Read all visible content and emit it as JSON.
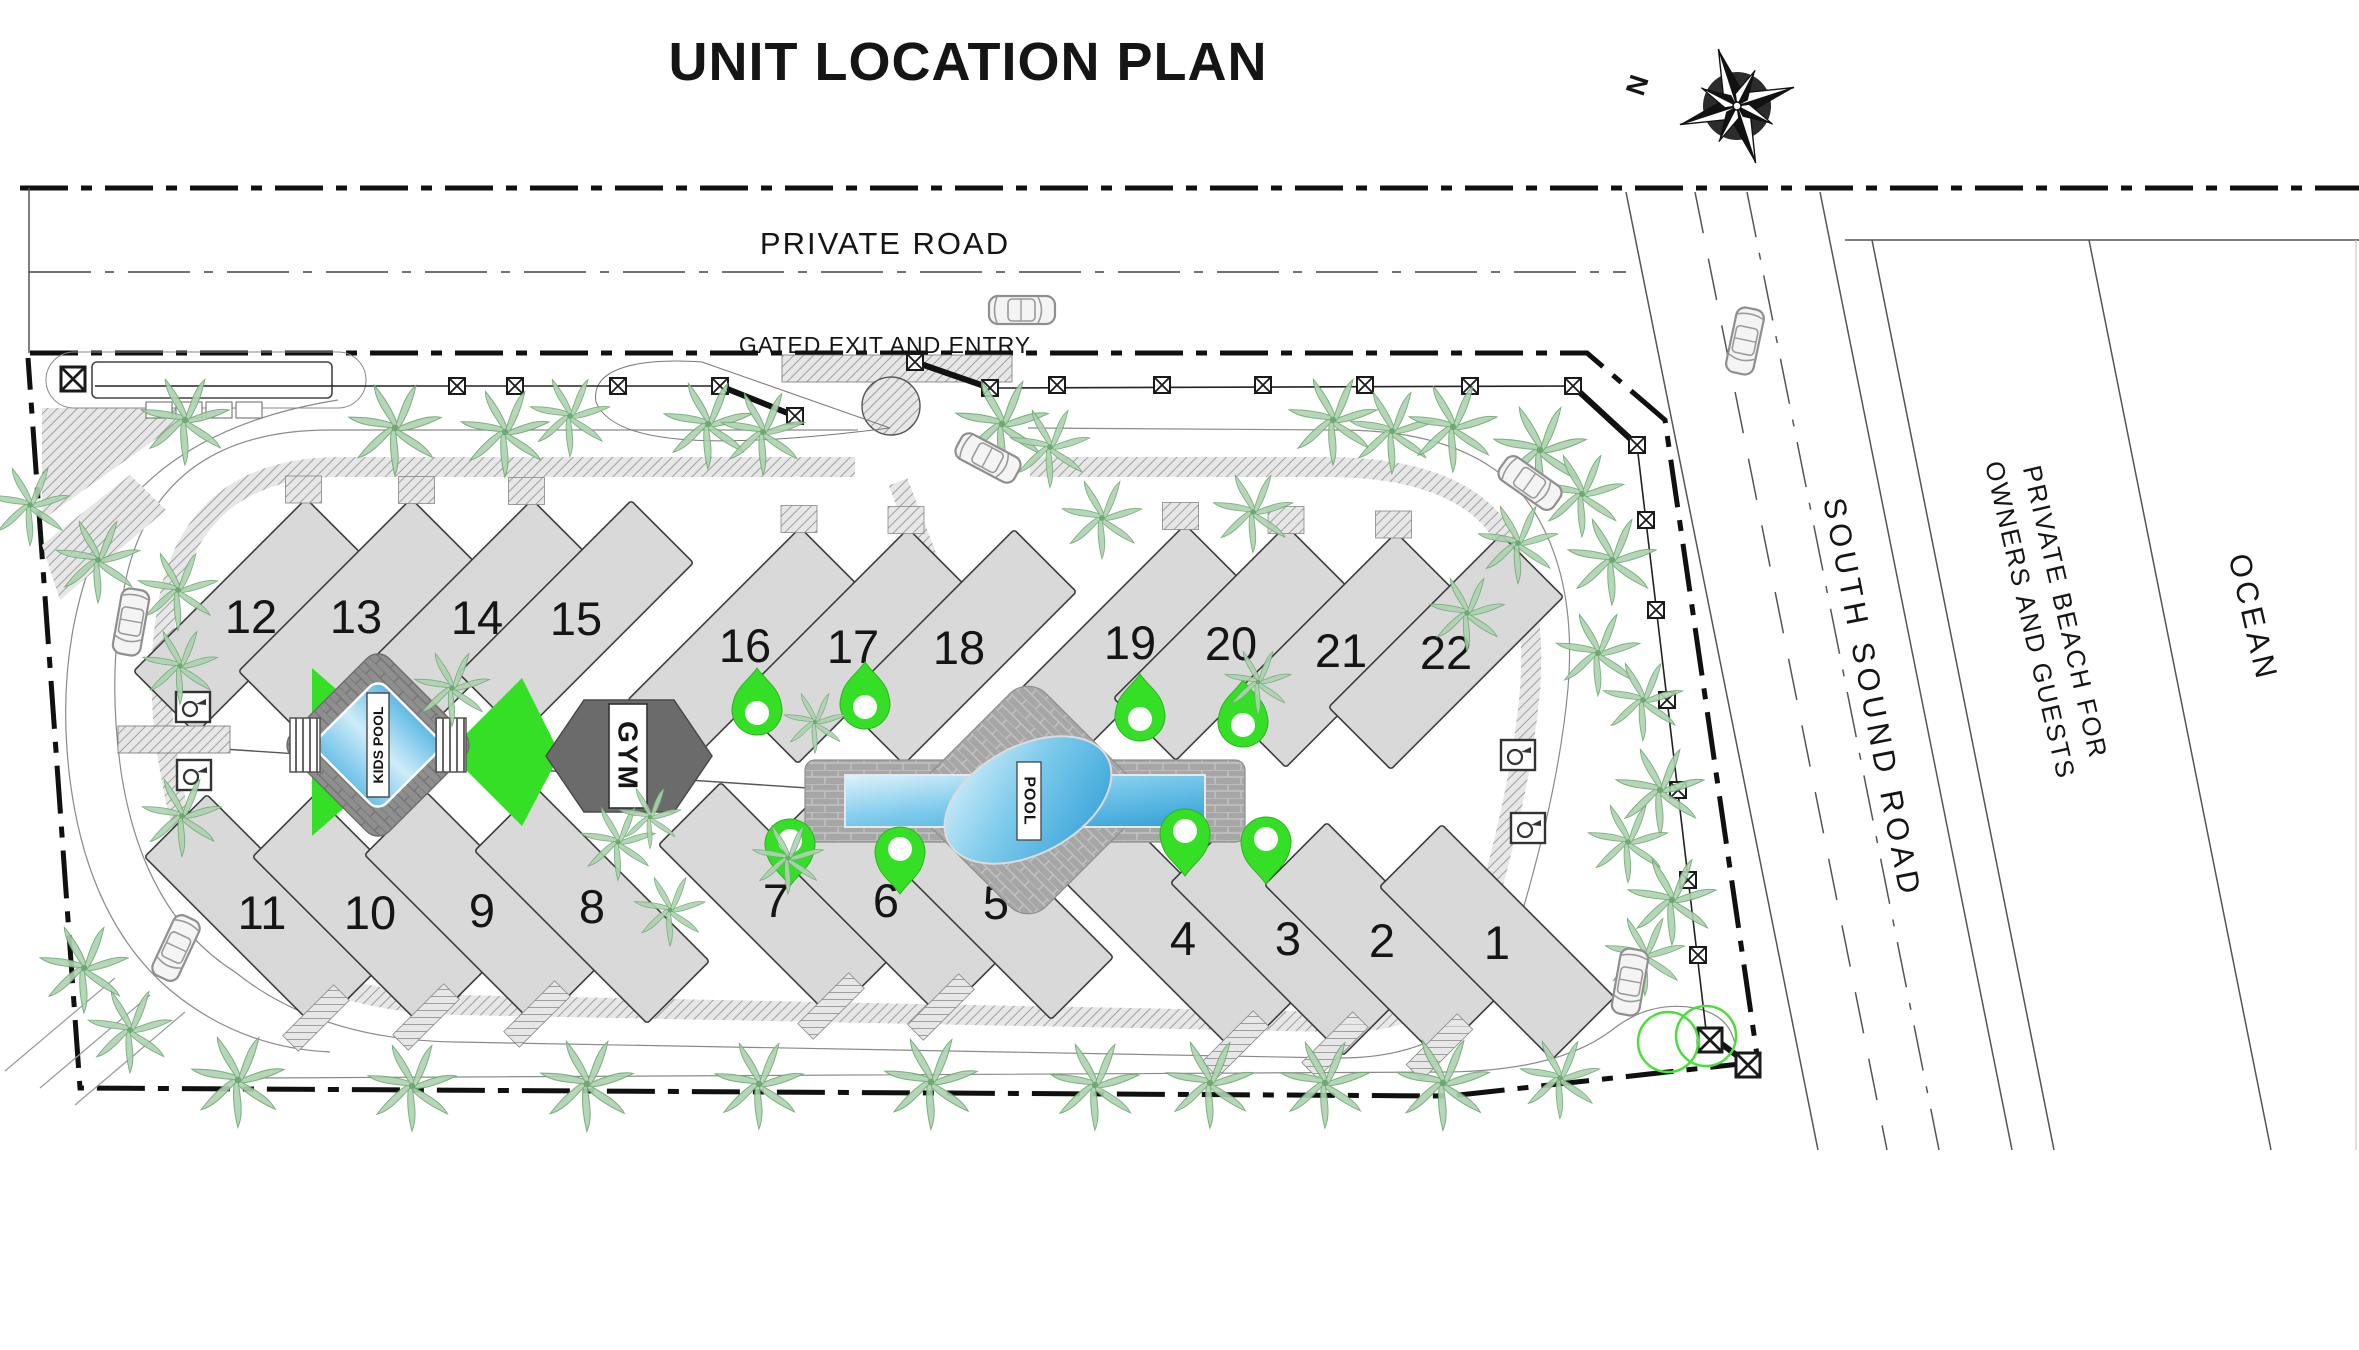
{
  "title": "UNIT LOCATION PLAN",
  "compass": {
    "north_label": "N"
  },
  "roads": {
    "private_road": "PRIVATE ROAD",
    "gate_label": "GATED EXIT AND ENTRY",
    "south_sound_road": "SOUTH SOUND ROAD"
  },
  "areas": {
    "beach_line1": "PRIVATE BEACH FOR",
    "beach_line2": "OWNERS AND GUESTS",
    "ocean": "OCEAN"
  },
  "amenities": {
    "kids_pool": "KIDS POOL",
    "gym": "GYM",
    "pool": "POOL"
  },
  "units": {
    "top_row": [
      {
        "n": "12",
        "x": 251,
        "y": 616
      },
      {
        "n": "13",
        "x": 356,
        "y": 616
      },
      {
        "n": "14",
        "x": 477,
        "y": 617
      },
      {
        "n": "15",
        "x": 576,
        "y": 618
      },
      {
        "n": "16",
        "x": 745,
        "y": 645
      },
      {
        "n": "17",
        "x": 853,
        "y": 646
      },
      {
        "n": "18",
        "x": 959,
        "y": 647
      },
      {
        "n": "19",
        "x": 1130,
        "y": 642
      },
      {
        "n": "20",
        "x": 1231,
        "y": 643
      },
      {
        "n": "21",
        "x": 1341,
        "y": 650
      },
      {
        "n": "22",
        "x": 1446,
        "y": 652
      }
    ],
    "bottom_row": [
      {
        "n": "11",
        "x": 262,
        "y": 912
      },
      {
        "n": "10",
        "x": 370,
        "y": 912
      },
      {
        "n": "9",
        "x": 482,
        "y": 910
      },
      {
        "n": "8",
        "x": 592,
        "y": 906
      },
      {
        "n": "7",
        "x": 776,
        "y": 900
      },
      {
        "n": "6",
        "x": 886,
        "y": 900
      },
      {
        "n": "5",
        "x": 996,
        "y": 902
      },
      {
        "n": "4",
        "x": 1183,
        "y": 938
      },
      {
        "n": "3",
        "x": 1288,
        "y": 938
      },
      {
        "n": "2",
        "x": 1382,
        "y": 940
      },
      {
        "n": "1",
        "x": 1497,
        "y": 942
      }
    ]
  },
  "colors": {
    "accent_green": "#35df25",
    "pool_blue": "#3fa8de",
    "deck_gray": "#a6a6a6",
    "dark_deck": "#8f8f8f",
    "gym_gray": "#6b6b6b",
    "palm_green": "#8fbf92"
  },
  "map": {
    "palms": [
      [
        185,
        420,
        1.0
      ],
      [
        395,
        428,
        1.05
      ],
      [
        505,
        432,
        1.0
      ],
      [
        570,
        416,
        0.9
      ],
      [
        708,
        424,
        1.0
      ],
      [
        763,
        432,
        0.95
      ],
      [
        1002,
        424,
        1.05
      ],
      [
        1050,
        447,
        0.9
      ],
      [
        1333,
        420,
        1.0
      ],
      [
        1392,
        431,
        0.95
      ],
      [
        1453,
        427,
        1.0
      ],
      [
        1540,
        450,
        1.05
      ],
      [
        1582,
        494,
        0.95
      ],
      [
        1612,
        560,
        1.0
      ],
      [
        1598,
        653,
        0.95
      ],
      [
        1643,
        700,
        0.9
      ],
      [
        1660,
        790,
        1.0
      ],
      [
        1628,
        842,
        0.9
      ],
      [
        1672,
        900,
        1.0
      ],
      [
        1645,
        955,
        0.9
      ],
      [
        1518,
        543,
        0.9
      ],
      [
        1467,
        613,
        0.85
      ],
      [
        30,
        505,
        0.9
      ],
      [
        98,
        560,
        0.95
      ],
      [
        178,
        590,
        0.9
      ],
      [
        180,
        666,
        0.85
      ],
      [
        182,
        816,
        0.9
      ],
      [
        84,
        968,
        1.0
      ],
      [
        130,
        1030,
        0.95
      ],
      [
        238,
        1080,
        1.05
      ],
      [
        412,
        1086,
        1.0
      ],
      [
        587,
        1084,
        1.05
      ],
      [
        759,
        1084,
        1.0
      ],
      [
        931,
        1082,
        1.05
      ],
      [
        1095,
        1085,
        1.0
      ],
      [
        1210,
        1083,
        1.0
      ],
      [
        1325,
        1083,
        1.0
      ],
      [
        1443,
        1083,
        1.05
      ],
      [
        1560,
        1078,
        0.9
      ],
      [
        452,
        688,
        0.85
      ],
      [
        618,
        842,
        0.85
      ],
      [
        670,
        910,
        0.8
      ],
      [
        788,
        858,
        0.8
      ],
      [
        650,
        817,
        0.7
      ],
      [
        1102,
        518,
        0.9
      ],
      [
        1253,
        512,
        0.9
      ],
      [
        815,
        722,
        0.7
      ],
      [
        1258,
        682,
        0.75
      ]
    ],
    "cars": [
      [
        1022,
        310,
        0
      ],
      [
        988,
        458,
        28
      ],
      [
        131,
        622,
        100
      ],
      [
        176,
        948,
        115
      ],
      [
        1530,
        483,
        35
      ],
      [
        1630,
        982,
        100
      ],
      [
        1745,
        341,
        102
      ]
    ],
    "pins_up": [
      [
        757,
        712
      ],
      [
        865,
        706
      ],
      [
        1140,
        718
      ],
      [
        1243,
        724
      ]
    ],
    "pins_down": [
      [
        790,
        842
      ],
      [
        900,
        850
      ],
      [
        1185,
        832
      ],
      [
        1266,
        840
      ]
    ],
    "fence_posts": [
      [
        457,
        386
      ],
      [
        515,
        386
      ],
      [
        618,
        386
      ],
      [
        720,
        386
      ],
      [
        795,
        416
      ],
      [
        915,
        362
      ],
      [
        990,
        388
      ],
      [
        1057,
        385
      ],
      [
        1162,
        385
      ],
      [
        1263,
        385
      ],
      [
        1365,
        385
      ],
      [
        1470,
        386
      ],
      [
        1573,
        386
      ],
      [
        1637,
        445
      ],
      [
        1646,
        520
      ],
      [
        1656,
        610
      ],
      [
        1667,
        700
      ],
      [
        1678,
        790
      ],
      [
        1688,
        880
      ],
      [
        1698,
        955
      ]
    ],
    "gate_posts": [
      [
        73,
        379
      ],
      [
        1710,
        1040
      ],
      [
        1748,
        1065
      ]
    ],
    "gate_bars": [
      [
        720,
        386,
        795,
        416
      ],
      [
        915,
        362,
        990,
        388
      ],
      [
        1573,
        386,
        1637,
        445
      ],
      [
        1706,
        1032,
        1748,
        1064
      ]
    ],
    "utility_boxes": [
      [
        193,
        707
      ],
      [
        194,
        775
      ],
      [
        1518,
        755
      ],
      [
        1528,
        828
      ]
    ],
    "green_circles": [
      [
        1668,
        1042,
        30
      ],
      [
        1706,
        1036,
        30
      ]
    ]
  }
}
